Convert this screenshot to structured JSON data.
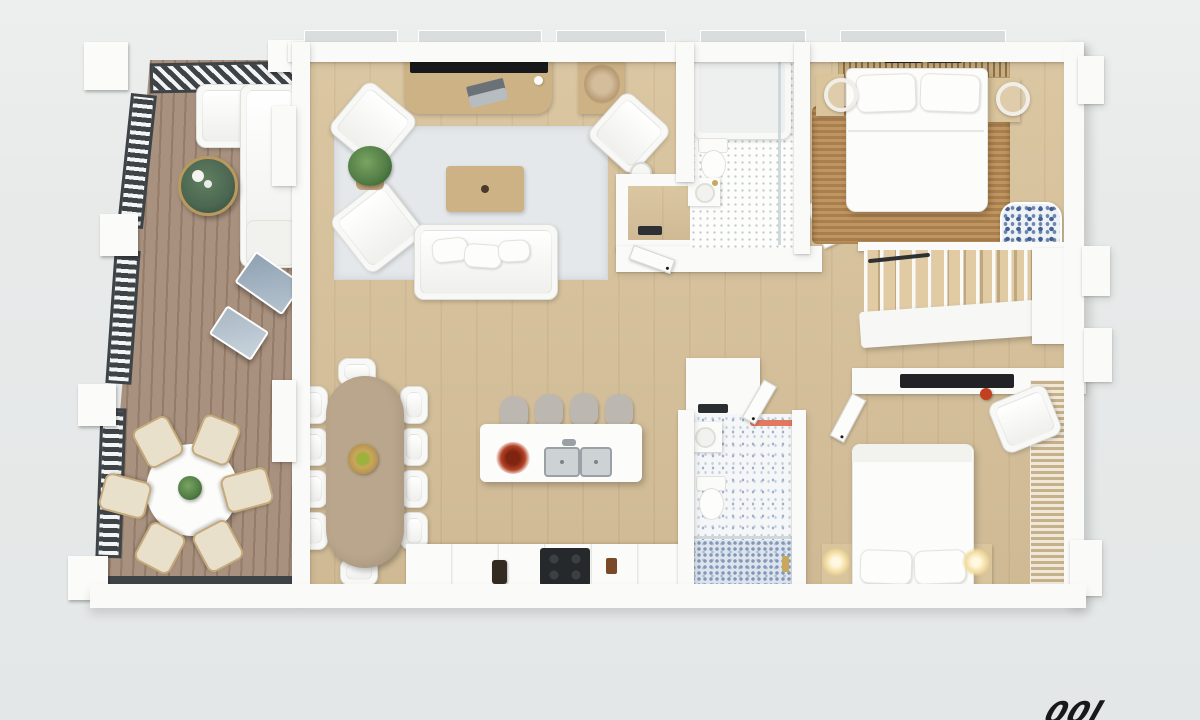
{
  "scene": {
    "type": "floor-plan-3d-render",
    "view": "top-down",
    "description": "Photorealistic 3D floor plan of a two-bedroom apartment with wrap-around deck, white walls and light oak floors",
    "text_labels": "none"
  },
  "watermark": {
    "partial_text": "00l"
  },
  "palette": {
    "background": "#e8eaea",
    "wall": "#fafaf8",
    "glass": "#d9dddd",
    "floor_wood": "#d8c29b",
    "deck_wood": "#a8917e",
    "deck_gap": "#937c6a",
    "railing_dark": "#3e4347",
    "rug_living": "#e4e8ea",
    "rug_jute": "#c09560",
    "jute_dark": "#a87f4e",
    "wood_mid": "#cdb286",
    "wood_table": "#b9a68c",
    "tv_black": "#17191c",
    "tile_dot": "#c3cbd0",
    "tile_blue": "#9fb0c4",
    "shower_blue": "#8199b6",
    "stool_gray": "#bcb8b1",
    "plant_green": "#4f7a43",
    "table_green": "#4c6652",
    "accent_coral": "#e0795d",
    "gold": "#c9a75b",
    "lamp_glow": "#f2dc9f",
    "dark_item": "#26292c"
  },
  "rooms": [
    {
      "name": "deck",
      "furniture": [
        "outdoor sectional sofa",
        "round green coffee table",
        "round outdoor dining table",
        "six patio chairs",
        "potted plant",
        "two leaning glass panels",
        "slatted privacy railing"
      ]
    },
    {
      "name": "living-room",
      "furniture": [
        "tv console",
        "flat-screen tv",
        "laptop",
        "light area rug",
        "two armchairs",
        "potted plant",
        "coffee table",
        "sofa with cushions",
        "reading chair",
        "floor lamp",
        "corner console with dried plant"
      ]
    },
    {
      "name": "dining-area",
      "furniture": [
        "oval wood dining table",
        "ten white chairs",
        "centerpiece bowl"
      ]
    },
    {
      "name": "kitchen",
      "furniture": [
        "island with double sink",
        "four bar stools",
        "red decorative plant",
        "cooktop",
        "base cabinets",
        "canister"
      ]
    },
    {
      "name": "entry-hall",
      "furniture": [
        "walk-in closet",
        "interior doors"
      ]
    },
    {
      "name": "bathroom-1",
      "furniture": [
        "bathtub",
        "glass shower screen",
        "toilet",
        "vanity sink",
        "dotted tile floor"
      ]
    },
    {
      "name": "bedroom-1",
      "furniture": [
        "double bed",
        "jute rug",
        "two nightstands",
        "two round hoop lamps",
        "slatted headboard bench",
        "floral pouf",
        "dried plant"
      ]
    },
    {
      "name": "staircase",
      "furniture": [
        "wood treads",
        "white balusters",
        "white landing",
        "dark handrail"
      ]
    },
    {
      "name": "bathroom-2",
      "furniture": [
        "laundry cabinet",
        "vanity sink",
        "toilet",
        "walk-in shower",
        "patterned tile floor",
        "coral towel rail",
        "gold fixture"
      ]
    },
    {
      "name": "bedroom-2",
      "furniture": [
        "double bed",
        "two glowing bedside lamps",
        "two nightstands",
        "built-in desk with dark top",
        "white armchair",
        "louvered wardrobe",
        "red vase"
      ]
    }
  ]
}
